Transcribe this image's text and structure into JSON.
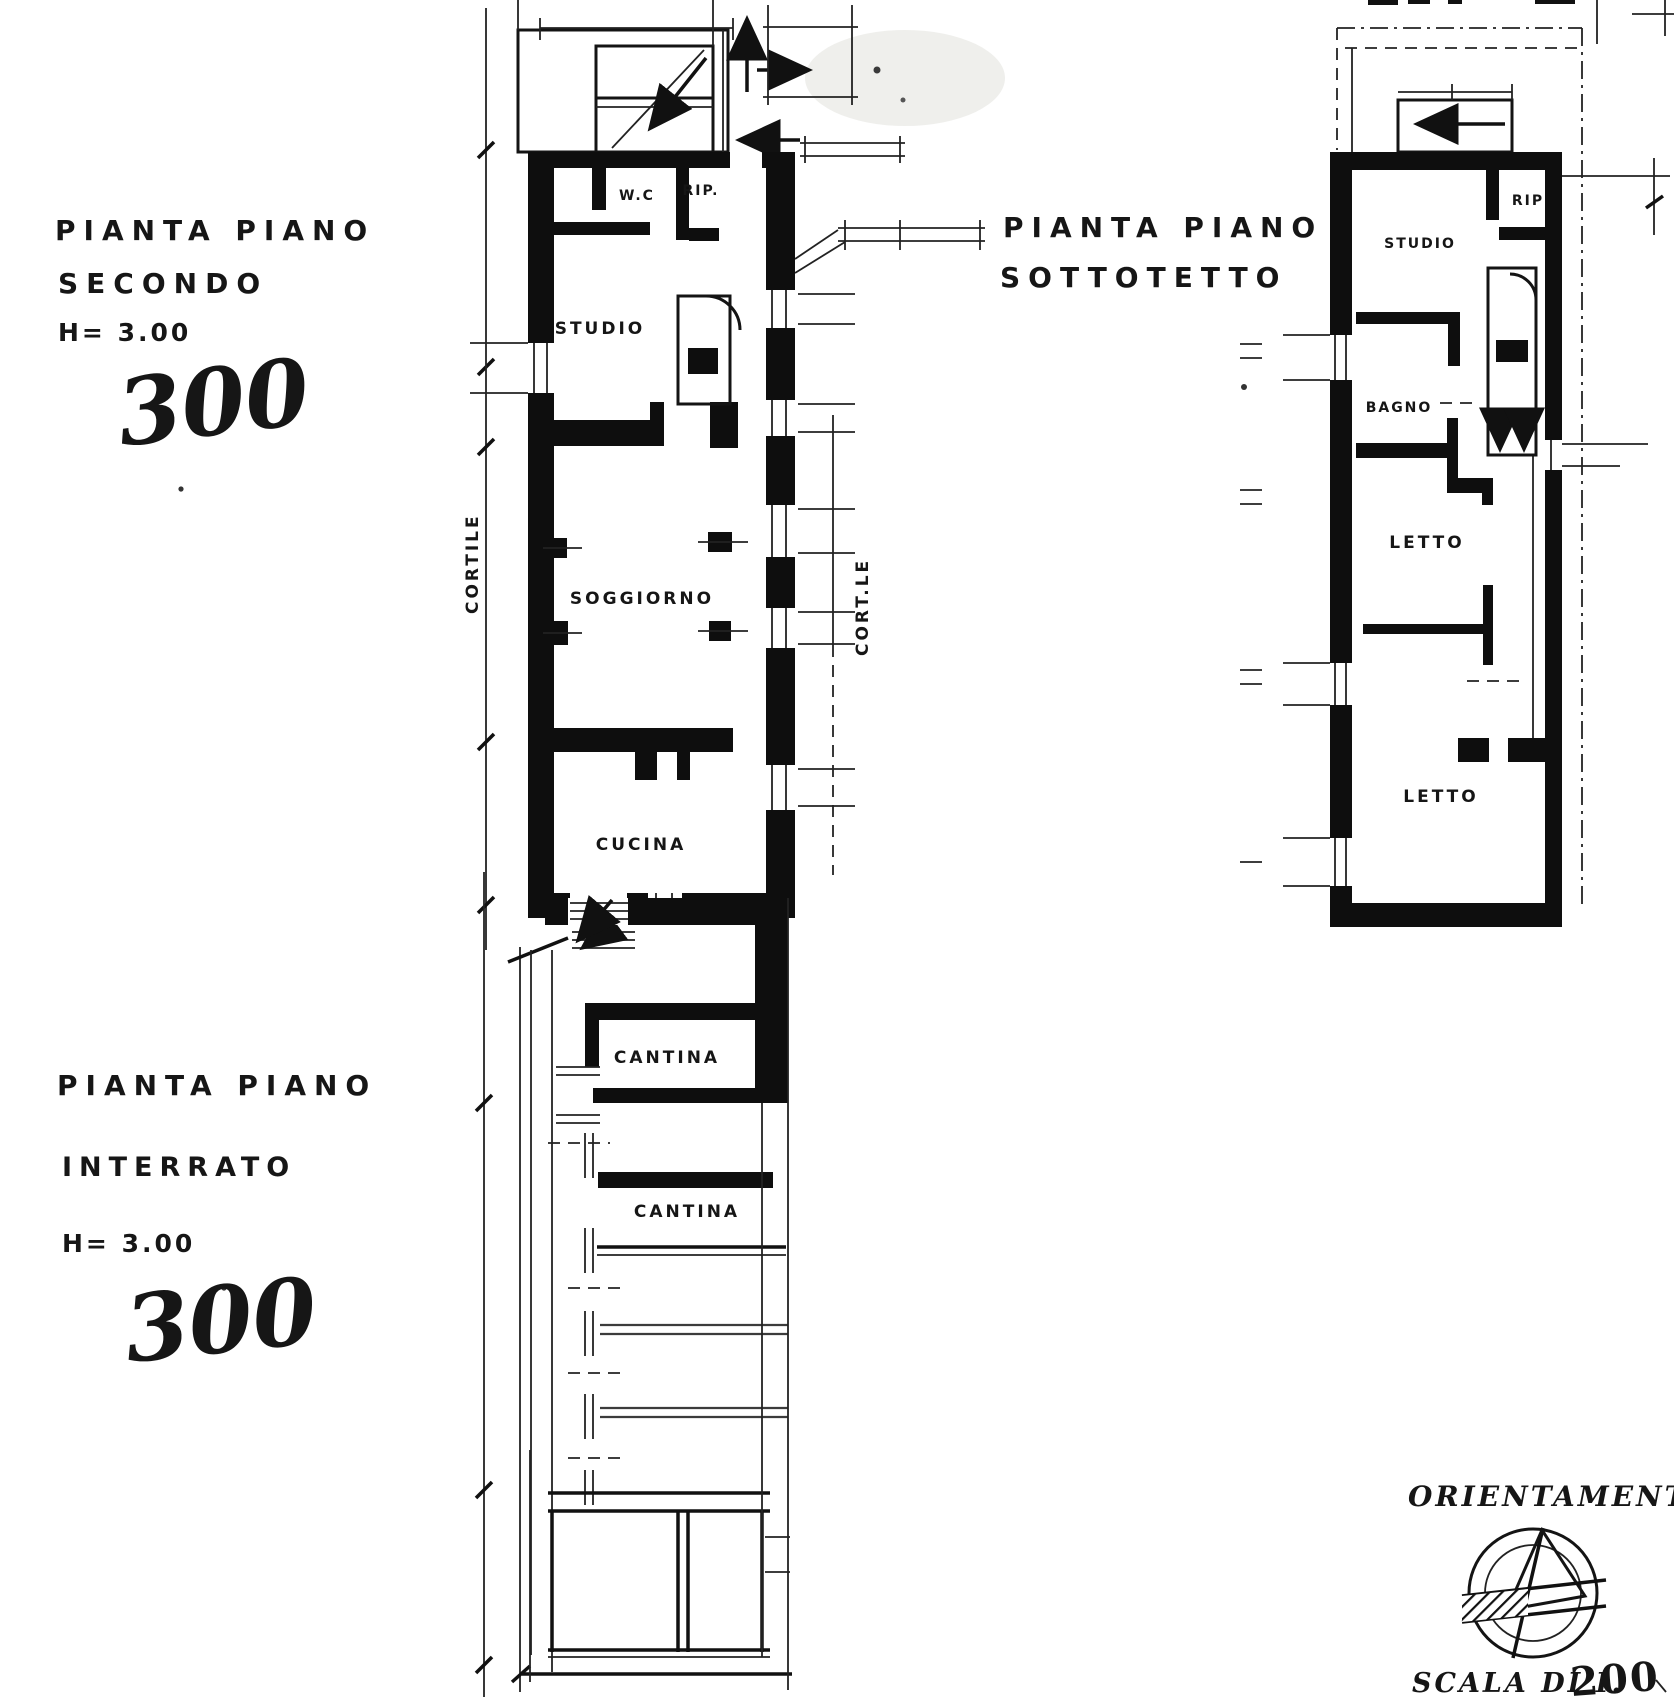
{
  "drawing": {
    "background": "#ffffff",
    "ink": "#141414",
    "plans": {
      "secondo": {
        "title_line1": "PIANTA PIANO",
        "title_line2": "SECONDO",
        "height_note": "H= 3.00",
        "height_handwritten": "300",
        "rooms": {
          "wc": "W.C",
          "rip": "RIP.",
          "studio": "STUDIO",
          "soggiorno": "SOGGIORNO",
          "cucina": "CUCINA"
        },
        "courtyard_left": "CORTILE",
        "courtyard_right": "CORT.LE"
      },
      "sottotetto": {
        "title_line1": "PIANTA PIANO",
        "title_line2": "SOTTOTETTO",
        "rooms": {
          "rip": "RIP",
          "studio": "STUDIO",
          "bagno": "BAGNO",
          "letto_upper": "LETTO",
          "letto_lower": "LETTO"
        }
      },
      "interrato": {
        "title_line1": "PIANTA PIANO",
        "title_line2": "INTERRATO",
        "height_note": "H= 3.00",
        "height_handwritten": "300",
        "rooms": {
          "cantina_upper": "CANTINA",
          "cantina_lower": "CANTINA"
        }
      }
    },
    "orientation": {
      "title": "ORIENTAMENTO",
      "compass_icon": "compass-rose-icon"
    },
    "scale": {
      "label": "SCALA DI I.",
      "value": "200"
    }
  }
}
